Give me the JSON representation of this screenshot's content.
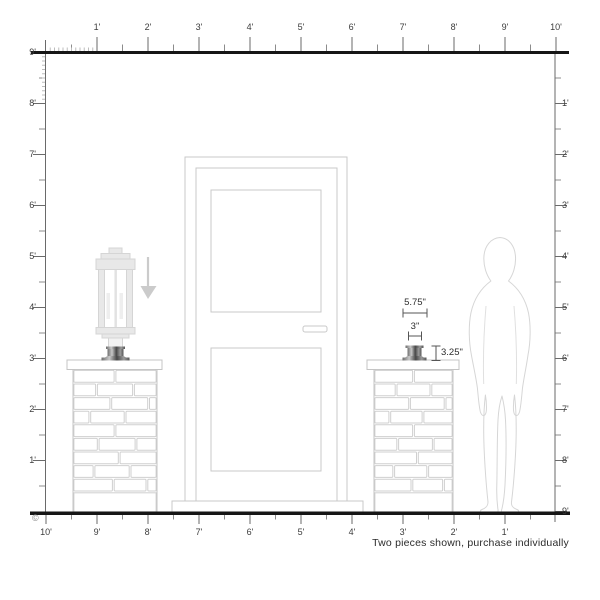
{
  "page": {
    "caption": "Two pieces shown, purchase individually",
    "copyright_symbol": "©"
  },
  "rulers": {
    "top_labels": [
      "1'",
      "2'",
      "3'",
      "4'",
      "5'",
      "6'",
      "7'",
      "8'",
      "9'",
      "10'"
    ],
    "bottom_labels": [
      "10'",
      "9'",
      "8'",
      "7'",
      "6'",
      "5'",
      "4'",
      "3'",
      "2'",
      "1'"
    ],
    "left_labels": [
      "9'",
      "8'",
      "7'",
      "6'",
      "5'",
      "4'",
      "3'",
      "2'",
      "1'"
    ],
    "right_labels": [
      "1'",
      "2'",
      "3'",
      "4'",
      "5'",
      "6'",
      "7'",
      "8'",
      "9'"
    ]
  },
  "dimensions": {
    "outer_width": "5.75\"",
    "inner_width": "3\"",
    "height": "3.25\""
  },
  "icons": {
    "down_arrow": "down-arrow-icon"
  },
  "colors": {
    "ink": "#161616",
    "tick": "#6a6a6a",
    "outline_light": "#cfcfcf",
    "ghost": "#d6d6d6",
    "metal_dark": "#4a4a4a"
  }
}
